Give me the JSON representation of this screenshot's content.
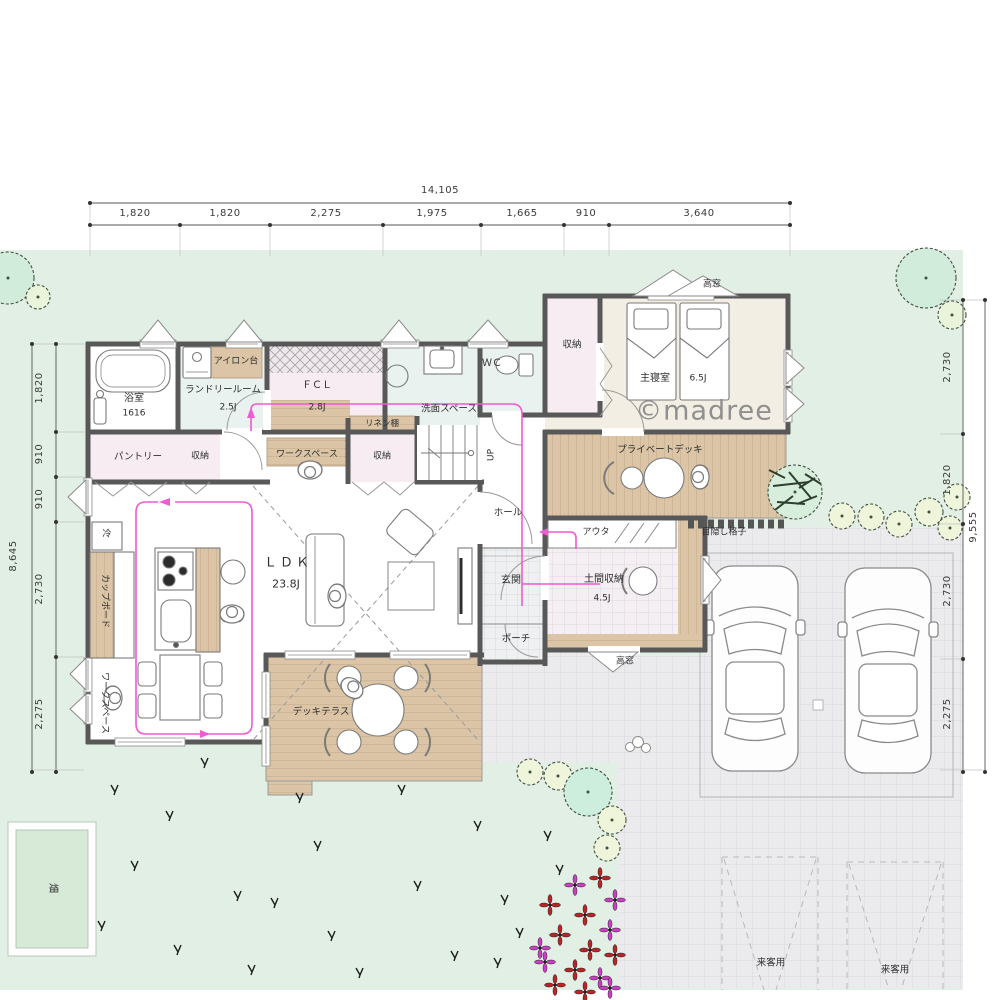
{
  "watermark": "©madree",
  "dimensions": {
    "top": {
      "total": "14,105",
      "segments": [
        "1,820",
        "1,820",
        "2,275",
        "1,975",
        "1,665",
        "910",
        "3,640"
      ]
    },
    "left": {
      "total": "8,645",
      "segments": [
        "1,820",
        "910",
        "910",
        "2,730",
        "2,275"
      ]
    },
    "right": {
      "total": "9,555",
      "segments": [
        "2,730",
        "1,820",
        "2,730",
        "2,275"
      ]
    }
  },
  "rooms": {
    "bathroom": {
      "name": "浴室",
      "size": "1616"
    },
    "laundry": {
      "name": "ランドリールーム",
      "size": "2.5J"
    },
    "ironing_board": "アイロン台",
    "fcl": {
      "name": "ＦＣＬ",
      "size": "2.8J"
    },
    "wash_space": "洗面スペース",
    "wc": "ＷＣ",
    "closet_wc": "収納",
    "bedroom": {
      "name": "主寝室",
      "size": "6.5J"
    },
    "high_window_top": "高窓",
    "high_window_bottom": "高窓",
    "pantry": "パントリー",
    "closet_pantry": "収納",
    "workspace_top": "ワークスペース",
    "linen_shelf": "リネン棚",
    "closet_stairs": "収納",
    "up": "UP",
    "hall": "ホール",
    "private_deck": "プライベートデッキ",
    "lattice": "目隠し格子",
    "ldk": {
      "name": "ＬＤＫ",
      "size": "23.8J"
    },
    "cupboard": "カップボード",
    "fridge": "冷",
    "workspace_side": "ワークスペース",
    "entrance": "玄関",
    "outer_closet": "アウタ",
    "doma_storage": {
      "name": "土間収納",
      "size": "4.5J"
    },
    "porch": "ポーチ",
    "deck_terrace": "デッキテラス",
    "field": "畑",
    "guest_parking_left": "来客用",
    "guest_parking_right": "来客用"
  },
  "colors": {
    "site_green": "#e2efe4",
    "pavement": "#ebebee",
    "wood": "#dbc5a6",
    "wall": "#585858",
    "flow_line": "#f05ad2",
    "tint_water": "#e9f2ef",
    "tint_closet": "#f6ecf2",
    "tint_bedroom": "#f3eee3"
  }
}
